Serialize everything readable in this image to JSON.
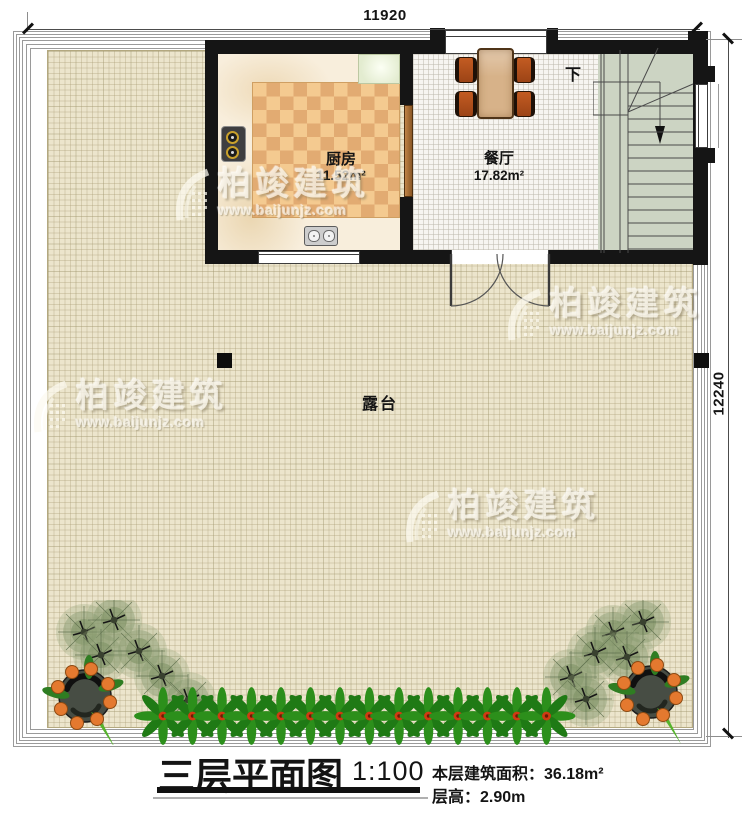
{
  "dimensions": {
    "width_top": "11920",
    "height_right": "12240"
  },
  "rooms": {
    "kitchen": {
      "name": "厨房",
      "area": "11.52m²"
    },
    "dining": {
      "name": "餐厅",
      "area": "17.82m²"
    },
    "terrace": {
      "name": "露台"
    }
  },
  "stairs": {
    "direction_label": "下"
  },
  "watermark": {
    "brand": "柏竣建筑",
    "url": "www.baijunjz.com"
  },
  "title_block": {
    "title": "三层平面图",
    "scale": "1:100",
    "floor_area_label": "本层建筑面积：",
    "floor_area_value": "36.18m²",
    "floor_height_label": "层高：",
    "floor_height_value": "2.90m"
  },
  "colors": {
    "wall": "#151515",
    "terrace_floor": "#ece5cc",
    "kitchen_rug_checker": "#f4ca90",
    "stairs_floor": "#ccd4c3",
    "plant_green": "#2c8f1b",
    "fruit_orange": "#e4792f",
    "chair_wood": "#b0511f",
    "table_wood": "#d7b289"
  }
}
